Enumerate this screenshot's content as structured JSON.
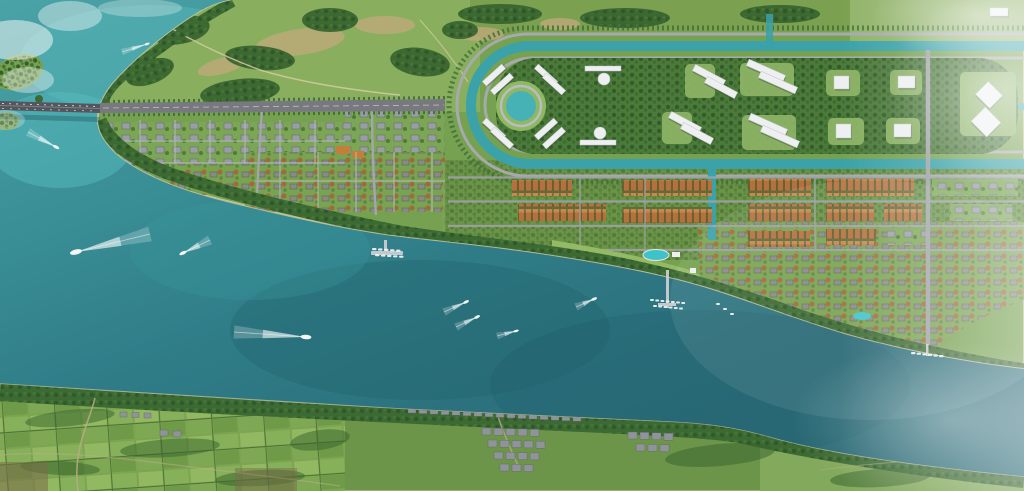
{
  "scene": {
    "title": "aerial-masterplan-render",
    "description": "Photorealistic bird's-eye rendering of a riverside master-planned resort town: a bridge crosses the river at left, a canal loop with circular lake and white civic buildings sits north, rows of orange-roof townhouses and villa grids line the waterfront with pools, piers and marinas; speedboats with white wakes cross the teal river; the far bank holds farmland and an existing village."
  },
  "colors": {
    "water_turquoise": "#4aa3a6",
    "water_bright": "#55bcbd",
    "water_mid": "#2f7c87",
    "water_deep": "#26626e",
    "canal_teal": "#3aa2a8",
    "pond_teal": "#47b2b6",
    "pool_aqua": "#3fc3ca",
    "land_green": "#76a150",
    "park_green": "#88ae5e",
    "lawn_green": "#8bb264",
    "field_green": "#7ba050",
    "forest_dark": "#35612c",
    "tree_dark": "#2f5629",
    "sand_tan": "#c3a97c",
    "beach": "#d6cb9f",
    "road_gray": "#9da0a5",
    "street_light": "#b6b9bd",
    "avenue_gray": "#77797f",
    "bridge_gray": "#53565c",
    "roof_orange": "#b5713d",
    "roof_gray": "#979ca3",
    "village_roof": "#8f949b",
    "building_white": "#edeff1",
    "dirt_tan": "#b9ac85",
    "wake_white": "#ffffff",
    "haze_white": "#ffffff"
  },
  "landmarks": [
    {
      "id": "bridge",
      "label": "river bridge with traffic"
    },
    {
      "id": "main-avenue",
      "label": "main boulevard from bridge"
    },
    {
      "id": "canal-loop",
      "label": "U-shaped canal with ring roads"
    },
    {
      "id": "central-pond",
      "label": "circular lake"
    },
    {
      "id": "forest-belt",
      "label": "central park forest"
    },
    {
      "id": "townhouse-district",
      "label": "orange-roof townhouse rows"
    },
    {
      "id": "west-residential-grid",
      "label": "villa grids west"
    },
    {
      "id": "resort-park",
      "label": "waterfront resort with pools"
    },
    {
      "id": "marinas",
      "label": "piers and moored boats"
    },
    {
      "id": "south-bank",
      "label": "far bank: farmland and village"
    }
  ],
  "boats": [
    {
      "x": 76,
      "y": 252,
      "tx": 150,
      "ty": 234,
      "s": 3.4
    },
    {
      "x": 183,
      "y": 253,
      "tx": 210,
      "ty": 240,
      "s": 2.2
    },
    {
      "x": 306,
      "y": 337,
      "tx": 234,
      "ty": 332,
      "s": 3.0
    },
    {
      "x": 56,
      "y": 147,
      "tx": 28,
      "ty": 132,
      "s": 2.0
    },
    {
      "x": 147,
      "y": 44,
      "tx": 122,
      "ty": 52,
      "s": 1.5
    },
    {
      "x": 466,
      "y": 302,
      "tx": 444,
      "ty": 312,
      "s": 1.8
    },
    {
      "x": 477,
      "y": 317,
      "tx": 456,
      "ty": 327,
      "s": 1.8
    },
    {
      "x": 516,
      "y": 331,
      "tx": 497,
      "ty": 336,
      "s": 1.6
    },
    {
      "x": 594,
      "y": 299,
      "tx": 576,
      "ty": 307,
      "s": 1.8
    }
  ],
  "marinas": [
    {
      "x": 372,
      "y": 248,
      "n": 5,
      "dx": 6,
      "dy": 0.4,
      "w": 4.5,
      "h": 2.2
    },
    {
      "x": 375,
      "y": 254,
      "n": 5,
      "dx": 6,
      "dy": 0.4,
      "w": 4.5,
      "h": 2.2
    },
    {
      "x": 650,
      "y": 299,
      "n": 7,
      "dx": 5.2,
      "dy": 0.5,
      "w": 4,
      "h": 2
    },
    {
      "x": 653,
      "y": 305,
      "n": 6,
      "dx": 5.2,
      "dy": 0.5,
      "w": 4,
      "h": 2
    },
    {
      "x": 911,
      "y": 352,
      "n": 6,
      "dx": 5.6,
      "dy": 0.6,
      "w": 4.5,
      "h": 2.2
    },
    {
      "x": 716,
      "y": 303,
      "n": 3,
      "dx": 7,
      "dy": 5,
      "w": 4,
      "h": 2
    }
  ],
  "white_buildings": [
    {
      "x": 481,
      "y": 72,
      "w": 26,
      "h": 6,
      "r": -42
    },
    {
      "x": 489,
      "y": 81,
      "w": 26,
      "h": 6,
      "r": -42
    },
    {
      "x": 533,
      "y": 72,
      "w": 26,
      "h": 6,
      "r": 42
    },
    {
      "x": 541,
      "y": 81,
      "w": 26,
      "h": 6,
      "r": 42
    },
    {
      "x": 481,
      "y": 126,
      "w": 26,
      "h": 6,
      "r": 42
    },
    {
      "x": 489,
      "y": 135,
      "w": 26,
      "h": 6,
      "r": 42
    },
    {
      "x": 533,
      "y": 126,
      "w": 26,
      "h": 6,
      "r": -42
    },
    {
      "x": 541,
      "y": 135,
      "w": 26,
      "h": 6,
      "r": -42
    },
    {
      "x": 585,
      "y": 66,
      "w": 36,
      "h": 5,
      "r": 0
    },
    {
      "x": 580,
      "y": 140,
      "w": 36,
      "h": 5,
      "r": 0
    },
    {
      "x": 692,
      "y": 72,
      "w": 34,
      "h": 7,
      "r": 28
    },
    {
      "x": 704,
      "y": 84,
      "w": 34,
      "h": 7,
      "r": 28
    },
    {
      "x": 746,
      "y": 67,
      "w": 40,
      "h": 7,
      "r": 24
    },
    {
      "x": 758,
      "y": 79,
      "w": 40,
      "h": 7,
      "r": 24
    },
    {
      "x": 748,
      "y": 121,
      "w": 40,
      "h": 7,
      "r": 24
    },
    {
      "x": 760,
      "y": 133,
      "w": 40,
      "h": 7,
      "r": 24
    },
    {
      "x": 668,
      "y": 119,
      "w": 34,
      "h": 7,
      "r": 28
    },
    {
      "x": 680,
      "y": 130,
      "w": 34,
      "h": 7,
      "r": 28
    },
    {
      "x": 834,
      "y": 76,
      "w": 15,
      "h": 13,
      "r": 0
    },
    {
      "x": 898,
      "y": 76,
      "w": 17,
      "h": 12,
      "r": 0
    },
    {
      "x": 836,
      "y": 124,
      "w": 15,
      "h": 14,
      "r": 0
    },
    {
      "x": 894,
      "y": 124,
      "w": 17,
      "h": 13,
      "r": 0
    },
    {
      "x": 979,
      "y": 86,
      "w": 20,
      "h": 18,
      "r": 45
    },
    {
      "x": 975,
      "y": 112,
      "w": 22,
      "h": 20,
      "r": 45
    },
    {
      "x": 990,
      "y": 8,
      "w": 18,
      "h": 8,
      "r": 0
    }
  ],
  "domes": [
    {
      "x": 604,
      "y": 79,
      "r": 6
    },
    {
      "x": 600,
      "y": 133,
      "r": 6
    }
  ],
  "lawns": [
    {
      "x": 740,
      "y": 63,
      "w": 54,
      "h": 33
    },
    {
      "x": 742,
      "y": 115,
      "w": 54,
      "h": 35
    },
    {
      "x": 826,
      "y": 70,
      "w": 34,
      "h": 26
    },
    {
      "x": 890,
      "y": 70,
      "w": 32,
      "h": 25
    },
    {
      "x": 828,
      "y": 118,
      "w": 36,
      "h": 27
    },
    {
      "x": 886,
      "y": 118,
      "w": 34,
      "h": 26
    },
    {
      "x": 960,
      "y": 72,
      "w": 56,
      "h": 64
    },
    {
      "x": 685,
      "y": 64,
      "w": 30,
      "h": 34
    },
    {
      "x": 662,
      "y": 112,
      "w": 30,
      "h": 32
    }
  ],
  "townhouse_rows": [
    {
      "x": 512,
      "y": 180,
      "w": 60,
      "h": 16,
      "t": "o"
    },
    {
      "x": 622,
      "y": 180,
      "w": 90,
      "h": 16,
      "t": "o"
    },
    {
      "x": 748,
      "y": 179,
      "w": 63,
      "h": 17,
      "t": "o"
    },
    {
      "x": 826,
      "y": 179,
      "w": 88,
      "h": 17,
      "t": "o"
    },
    {
      "x": 932,
      "y": 179,
      "w": 86,
      "h": 17,
      "t": "g"
    },
    {
      "x": 518,
      "y": 204,
      "w": 88,
      "h": 17,
      "t": "o"
    },
    {
      "x": 622,
      "y": 207,
      "w": 90,
      "h": 16,
      "t": "o"
    },
    {
      "x": 748,
      "y": 204,
      "w": 63,
      "h": 17,
      "t": "o"
    },
    {
      "x": 826,
      "y": 204,
      "w": 48,
      "h": 17,
      "t": "o"
    },
    {
      "x": 884,
      "y": 204,
      "w": 38,
      "h": 17,
      "t": "o"
    },
    {
      "x": 950,
      "y": 204,
      "w": 62,
      "h": 17,
      "t": "g"
    },
    {
      "x": 748,
      "y": 231,
      "w": 62,
      "h": 16,
      "t": "o"
    },
    {
      "x": 826,
      "y": 229,
      "w": 50,
      "h": 16,
      "t": "o"
    },
    {
      "x": 888,
      "y": 229,
      "w": 42,
      "h": 16,
      "t": "g"
    }
  ],
  "tree_clumps": [
    {
      "x": 180,
      "y": 30,
      "rx": 30,
      "ry": 14,
      "r": -10
    },
    {
      "x": 260,
      "y": 58,
      "rx": 35,
      "ry": 12,
      "r": 5
    },
    {
      "x": 330,
      "y": 20,
      "rx": 28,
      "ry": 12,
      "r": 0
    },
    {
      "x": 420,
      "y": 62,
      "rx": 30,
      "ry": 14,
      "r": 8
    },
    {
      "x": 500,
      "y": 14,
      "rx": 42,
      "ry": 10,
      "r": 0
    },
    {
      "x": 625,
      "y": 18,
      "rx": 45,
      "ry": 10,
      "r": 0
    },
    {
      "x": 780,
      "y": 14,
      "rx": 40,
      "ry": 9,
      "r": 0
    },
    {
      "x": 240,
      "y": 92,
      "rx": 40,
      "ry": 13,
      "r": -6
    },
    {
      "x": 150,
      "y": 72,
      "rx": 25,
      "ry": 12,
      "r": -20
    },
    {
      "x": 460,
      "y": 30,
      "rx": 18,
      "ry": 9,
      "r": 0
    }
  ],
  "sand_patches": [
    {
      "x": 300,
      "y": 42,
      "rx": 45,
      "ry": 13,
      "r": -8
    },
    {
      "x": 385,
      "y": 25,
      "rx": 30,
      "ry": 9,
      "r": 0
    },
    {
      "x": 222,
      "y": 66,
      "rx": 25,
      "ry": 8,
      "r": -15
    },
    {
      "x": 480,
      "y": 34,
      "rx": 24,
      "ry": 7,
      "r": 0
    },
    {
      "x": 560,
      "y": 24,
      "rx": 20,
      "ry": 6,
      "r": 0
    }
  ],
  "farm_hedges": [
    {
      "x": 70,
      "y": 418,
      "rx": 45,
      "ry": 8,
      "r": -6
    },
    {
      "x": 170,
      "y": 448,
      "rx": 50,
      "ry": 9,
      "r": -4
    },
    {
      "x": 60,
      "y": 468,
      "rx": 40,
      "ry": 7,
      "r": 3
    },
    {
      "x": 260,
      "y": 478,
      "rx": 45,
      "ry": 8,
      "r": -3
    },
    {
      "x": 320,
      "y": 440,
      "rx": 30,
      "ry": 10,
      "r": -8
    },
    {
      "x": 720,
      "y": 455,
      "rx": 55,
      "ry": 11,
      "r": -5
    },
    {
      "x": 880,
      "y": 478,
      "rx": 50,
      "ry": 9,
      "r": -3
    }
  ],
  "village": {
    "shore_row": {
      "x": 408,
      "y": 407,
      "n": 16,
      "dx": 11,
      "dy": 0.55,
      "w": 8,
      "h": 6
    },
    "clusters": [
      {
        "x": 482,
        "y": 428,
        "n": 5,
        "dx": 12,
        "dy": 0.3,
        "w": 9,
        "h": 7
      },
      {
        "x": 488,
        "y": 440,
        "n": 5,
        "dx": 12,
        "dy": 0.3,
        "w": 9,
        "h": 7
      },
      {
        "x": 494,
        "y": 452,
        "n": 4,
        "dx": 12,
        "dy": 0.3,
        "w": 9,
        "h": 7
      },
      {
        "x": 500,
        "y": 464,
        "n": 3,
        "dx": 12,
        "dy": 0.3,
        "w": 9,
        "h": 7
      },
      {
        "x": 628,
        "y": 432,
        "n": 4,
        "dx": 12,
        "dy": 0.4,
        "w": 9,
        "h": 7
      },
      {
        "x": 636,
        "y": 444,
        "n": 3,
        "dx": 12,
        "dy": 0.4,
        "w": 9,
        "h": 7
      },
      {
        "x": 160,
        "y": 430,
        "n": 2,
        "dx": 13,
        "dy": 1,
        "w": 8,
        "h": 6
      },
      {
        "x": 120,
        "y": 412,
        "n": 3,
        "dx": 12,
        "dy": 0.5,
        "w": 7,
        "h": 5
      }
    ]
  }
}
